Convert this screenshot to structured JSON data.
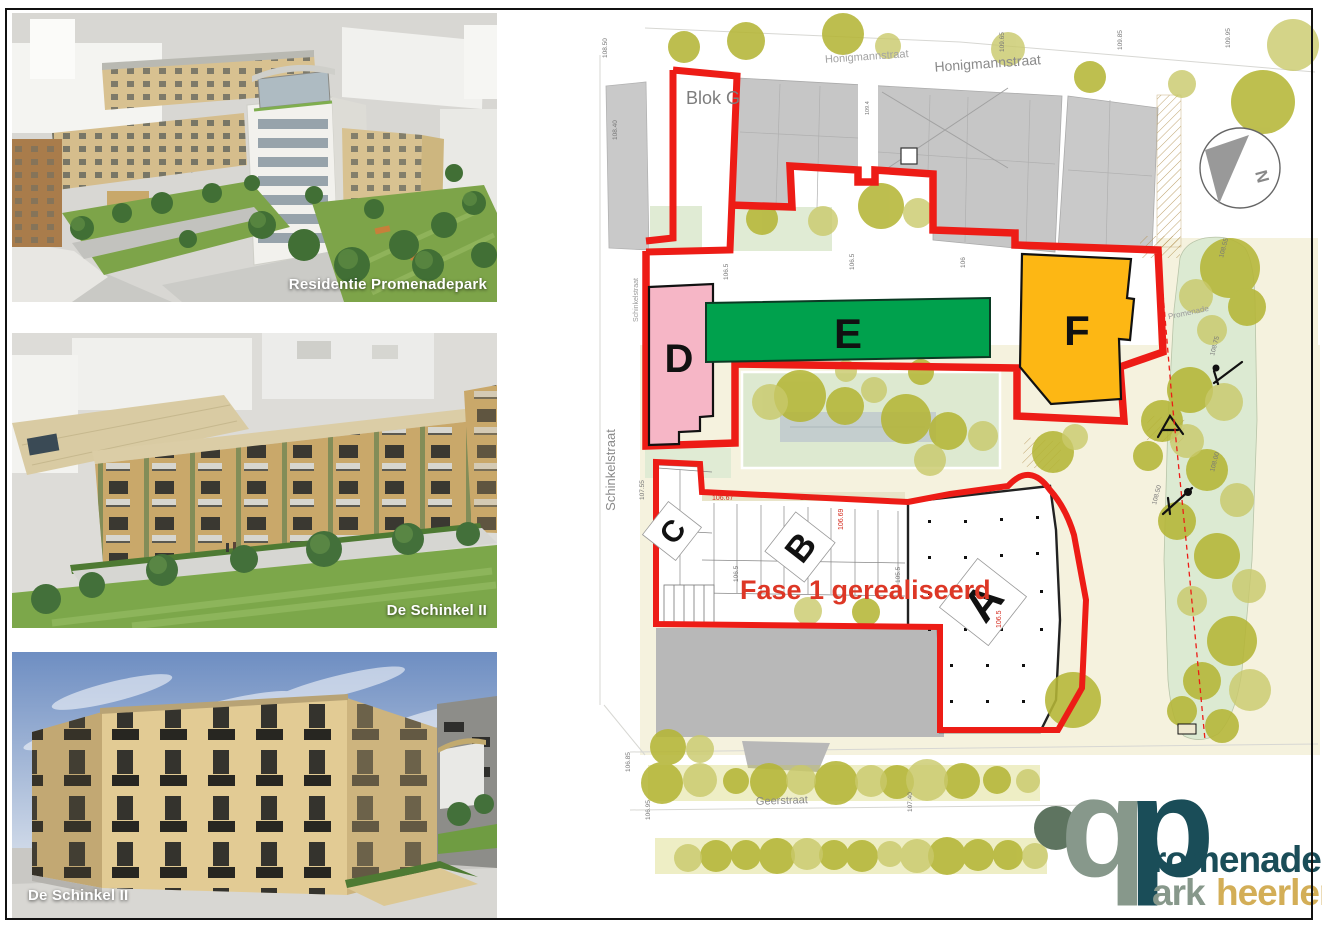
{
  "renders": [
    {
      "caption": "Residentie Promenadepark"
    },
    {
      "caption": "De Schinkel II"
    },
    {
      "caption": "De Schinkel II"
    }
  ],
  "map": {
    "streets": {
      "honigmannstraat_left": "Honigmannstraat",
      "honigmannstraat_right": "Honigmannstraat",
      "schinkelstraat": "Schinkelstraat",
      "schinkelstraat_small": "Schinkelstraat",
      "geerstraat": "Geerstraat",
      "promenade": "Promenade"
    },
    "areas": {
      "blok_g": "Blok G",
      "fase1": "Fase 1 gerealiseerd"
    },
    "blocks": {
      "a": "A",
      "b": "B",
      "c": "C",
      "d": "D",
      "e": "E",
      "f": "F"
    },
    "block_colors": {
      "d": "#f6b6c6",
      "e": "#00a14d",
      "f": "#fdb714"
    },
    "boundary_color": "#ed1c16",
    "compass": {
      "north": "N"
    },
    "elevations": [
      "108.50",
      "108.40",
      "109.65",
      "109.85",
      "109.95",
      "109.4",
      "106.5",
      "106.5",
      "106",
      "106.67",
      "106.67",
      "106.69",
      "106.5",
      "105.5",
      "106.5",
      "106.85",
      "106.95",
      "107.40",
      "108.55",
      "108.75",
      "108.00",
      "108.50",
      "107.55"
    ]
  },
  "logo": {
    "glyph_left": "p",
    "glyph_right": "p",
    "word_top": "romenade",
    "word_bottom_1": "ark",
    "word_bottom_2": "heerlen",
    "colors": {
      "sage": "#87988b",
      "teal": "#1a4d58",
      "gold": "#d3ae57"
    }
  }
}
